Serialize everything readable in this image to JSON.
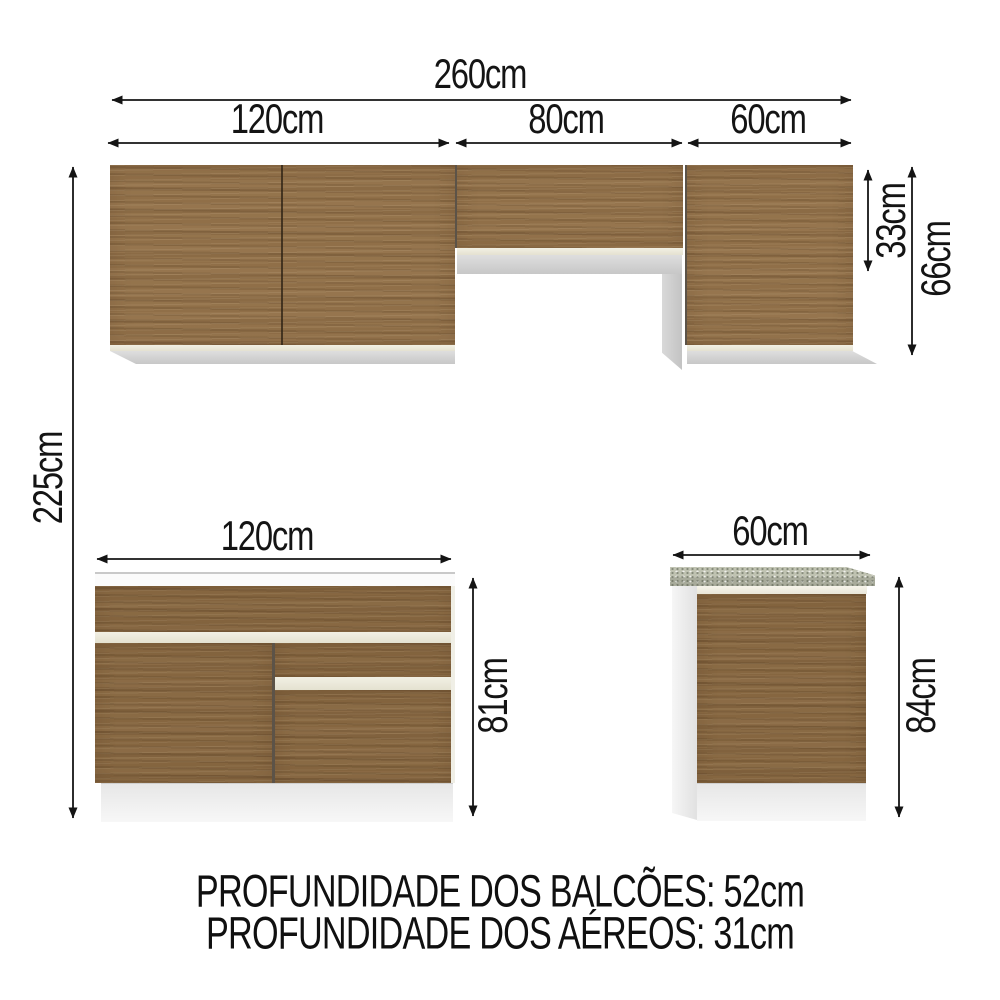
{
  "title": "Diagrama de medidas - cozinha completa",
  "dims": {
    "total_width": "260cm",
    "upper_left_width": "120cm",
    "upper_mid_width": "80cm",
    "upper_right_width": "60cm",
    "upper_mid_height": "33cm",
    "upper_cabinet_height": "66cm",
    "total_height": "225cm",
    "base_left_width": "120cm",
    "base_left_height": "81cm",
    "base_right_width": "60cm",
    "base_right_height": "84cm"
  },
  "footer": {
    "counters_depth": "PROFUNDIDADE DOS BALCÕES: 52cm",
    "uppers_depth": "PROFUNDIDADE DOS AÉREOS: 31cm"
  },
  "colors": {
    "wood_brown": "#91704a",
    "dimension_black": "#141414",
    "countertop_gray": "#b4b7a8",
    "cabinet_white": "#f2f2f2",
    "cream_edge": "#eceadb"
  }
}
